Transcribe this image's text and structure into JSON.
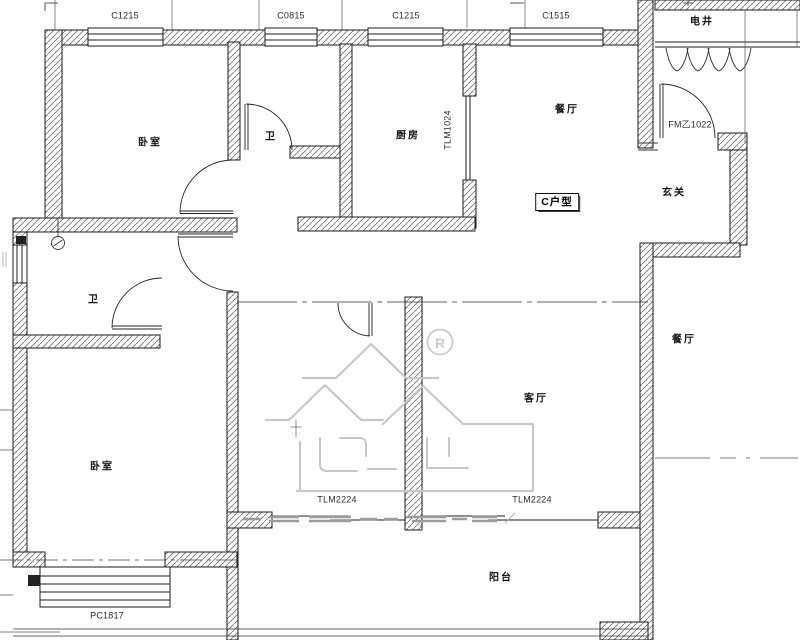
{
  "unit_type_label": "C户型",
  "rooms": {
    "bedroom_top": "卧室",
    "bath_top": "卫",
    "kitchen": "厨房",
    "dining": "餐厅",
    "electrical_shaft": "电井",
    "entry_hall": "玄关",
    "bath_middle": "卫",
    "dining_neighbor": "餐厅",
    "living_room": "客厅",
    "bedroom_bottom": "卧室",
    "balcony": "阳台"
  },
  "openings": {
    "window_bedroom_top": "C1215",
    "window_bath_top": "C0815",
    "window_kitchen": "C1215",
    "window_dining": "C1515",
    "entry_fire_door": "FM乙1022",
    "kitchen_sliding_door": "TLM1024",
    "balcony_sliding_door_left": "TLM2224",
    "balcony_sliding_door_right": "TLM2224",
    "bay_window_bedroom_bottom": "PC1817"
  },
  "watermark": {
    "registered_mark": "R"
  },
  "colors": {
    "background": "#ffffff",
    "line": "#1b1b1b",
    "hatch": "#6f6f6f",
    "watermark": "#c7c7c7"
  }
}
